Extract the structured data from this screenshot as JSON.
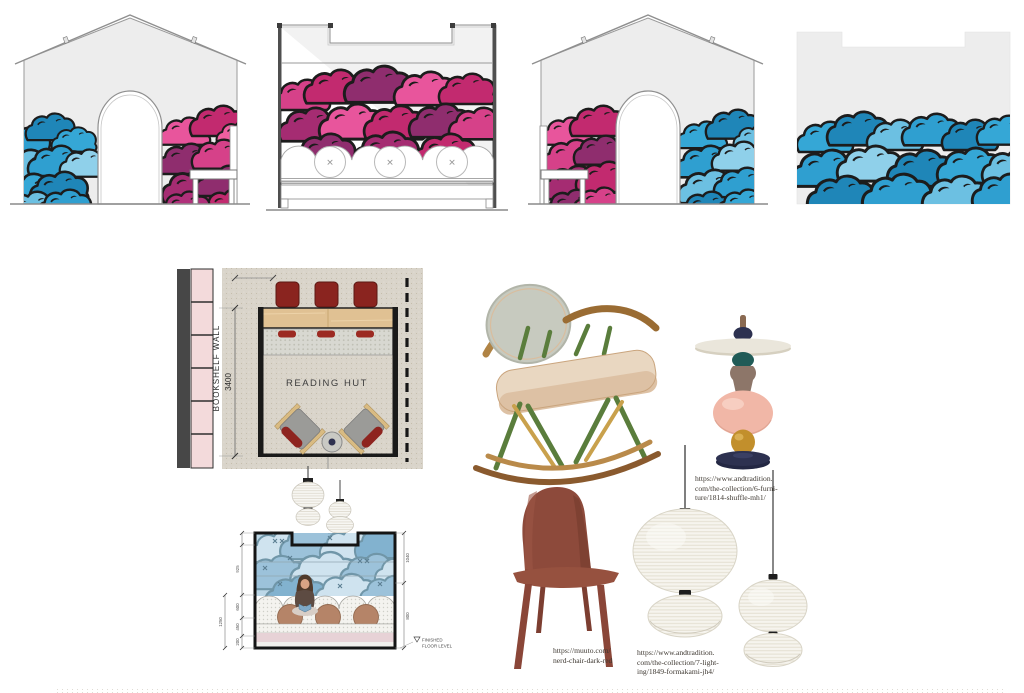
{
  "board": {
    "background": "#ffffff"
  },
  "colors": {
    "cloud_outline": "#1c1c1c",
    "cloud_blues": [
      "#8fd0ea",
      "#6cc0e2",
      "#35a7d6",
      "#2f9fd0",
      "#1f86b8"
    ],
    "cloud_pinks": [
      "#e8559c",
      "#d64189",
      "#c22a6f",
      "#a52c72",
      "#8f2d6e"
    ],
    "wall_fill": "#ededed",
    "mural_blue": "#bdd8e8",
    "bookshelf_pink": "#f3dadb",
    "counter_wood": "#e0c193",
    "chair_red": "#8a241f",
    "cushion_brown": "#b58468",
    "nerd_red": "#8d4a3b",
    "paper_white": "#f6f4ee"
  },
  "plan": {
    "bookshelf_label": "BOOKSHELF WALL",
    "width_dimension": "3400",
    "room_label": "READING HUT"
  },
  "section": {
    "floor_note_line1": "FINISHED",
    "floor_note_line2": "FLOOR LEVEL",
    "dims_left": [
      "925",
      "600",
      "450",
      "200"
    ],
    "dim_total": "1250",
    "dims_right": [
      "1040",
      "800"
    ]
  },
  "elevations": {
    "cushion_mark": "✕"
  },
  "products": {
    "shuffle_table": {
      "url_lines": [
        "https://www.andtradition.",
        "com/the-collection/6-furni-",
        "ture/1814-shuffle-mh1/"
      ]
    },
    "nerd_chair": {
      "url_lines": [
        "https://muuto.com/",
        "nerd-chair-dark-red"
      ]
    },
    "formakami": {
      "url_lines": [
        "https://www.andtradition.",
        "com/the-collection/7-light-",
        "ing/1849-formakami-jh4/"
      ]
    }
  }
}
